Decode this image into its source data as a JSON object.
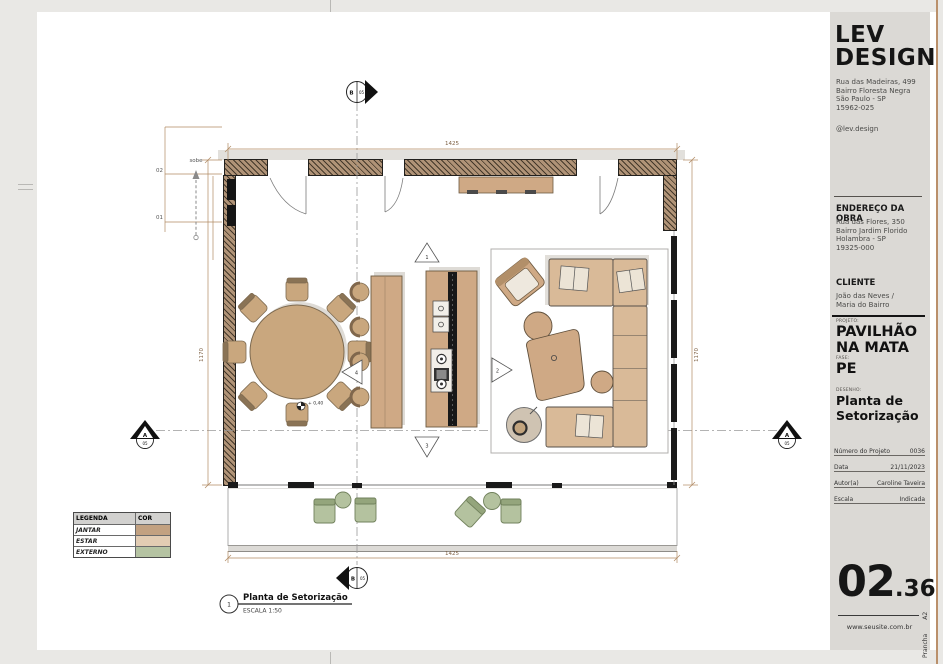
{
  "titleblock": {
    "logo_line1": "LEV",
    "logo_line2": "DESIGN",
    "office_address": [
      "Rua das Madeiras, 499",
      "Bairro Floresta Negra",
      "São Paulo - SP",
      "15962-025"
    ],
    "social": "@lev.design",
    "site_heading": "ENDEREÇO DA OBRA",
    "site_address": [
      "Rua das Flores, 350",
      "Bairro Jardim Florido",
      "Holambra - SP",
      "19325-000"
    ],
    "client_heading": "CLIENTE",
    "client_line1": "João das Neves /",
    "client_line2": "Maria do Bairro",
    "project_label": "PROJETO:",
    "project_line1": "PAVILHÃO",
    "project_line2": "NA MATA",
    "phase_label": "FASE:",
    "phase": "PE",
    "drawing_label": "DESENHO:",
    "drawing_line1": "Planta de",
    "drawing_line2": "Setorização",
    "fields": [
      {
        "label": "Número do Projeto",
        "value": "0036"
      },
      {
        "label": "Data",
        "value": "21/11/2023"
      },
      {
        "label": "Autor(a)",
        "value": "Caroline Taveira"
      },
      {
        "label": "Escala",
        "value": "Indicada"
      }
    ],
    "sheet_number": {
      "major": "02",
      "minor": ".36"
    },
    "website": "www.seusite.com.br",
    "prancha": {
      "label": "Prancha",
      "value": "A2"
    }
  },
  "legend": {
    "header": [
      "LEGENDA",
      "COR"
    ],
    "rows": [
      {
        "label": "JANTAR",
        "color": "#c2a181"
      },
      {
        "label": "ESTAR",
        "color": "#e2ccb3"
      },
      {
        "label": "EXTERNO",
        "color": "#b5c3a2"
      }
    ]
  },
  "drawing_title": {
    "bubble": "1",
    "title": "Planta de Setorização",
    "scale": "ESCALA 1:50"
  },
  "plan": {
    "dimensions": {
      "top": "1425",
      "bottom": "1425",
      "left": "1170",
      "right": "1170"
    },
    "stair": {
      "label": "sobe",
      "upper": "02",
      "lower": "01"
    },
    "level": "+ 0,40",
    "sections": {
      "top": {
        "letter": "B",
        "number": "05"
      },
      "bottom": {
        "letter": "B",
        "number": "05"
      },
      "left": {
        "letter": "A",
        "number": "05"
      },
      "right": {
        "letter": "A",
        "number": "05"
      }
    },
    "views": [
      "1",
      "2",
      "3",
      "4"
    ]
  },
  "colors": {
    "dining": "#c9a77e",
    "estar": "#d9ba98",
    "externo": "#b4c29f"
  }
}
